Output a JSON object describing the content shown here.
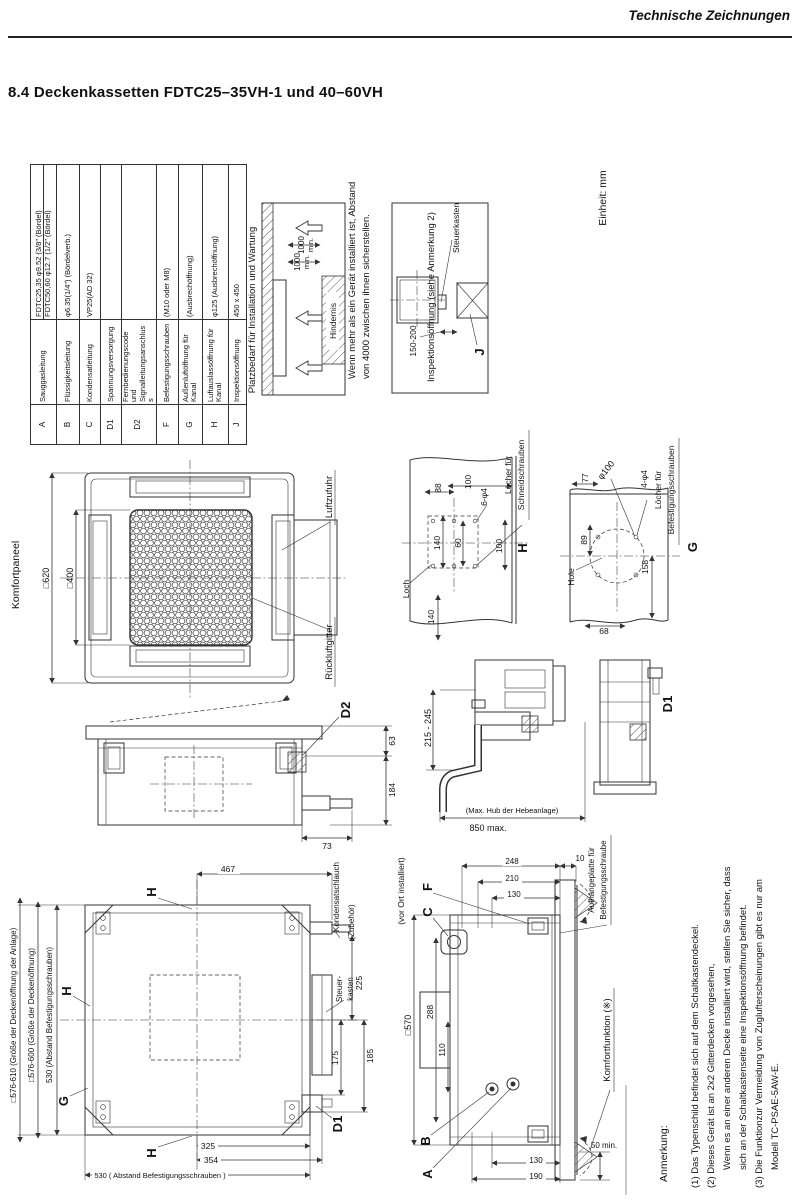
{
  "page": {
    "doc_header": "Technische Zeichnungen",
    "section_title": "8.4  Deckenkassetten FDTC25–35VH-1 und 40–60VH",
    "unit_note": "Einheit: mm"
  },
  "spec_table": {
    "rows": [
      {
        "symbol": "A",
        "name": "Sauggasleitung",
        "value": "FDTC25,35  φ9.52 (3/8\" (Bördel)",
        "value2": "FDTC50,60  φ12.7 (1/2\" (Bördel)"
      },
      {
        "symbol": "B",
        "name": "Flüssigkeitsleitung",
        "value": "φ6.35(1/4\") (Bördelverb.)"
      },
      {
        "symbol": "C",
        "name": "Kondensatleitung",
        "value": "VP25(AD 32)"
      },
      {
        "symbol": "D1",
        "name": "Spannungsversorgung",
        "value": ""
      },
      {
        "symbol": "D2",
        "name": "Fernbedienungscode und Signalleitungsanschluss",
        "value": ""
      },
      {
        "symbol": "F",
        "name": "Befestigungsschrauben",
        "value": "(M10 oder M8)"
      },
      {
        "symbol": "G",
        "name": "Außenluftöffnung für Kanal",
        "value": "(Ausbrechöffnung)"
      },
      {
        "symbol": "H",
        "name": "Luftauslassöffnung für Kanal",
        "value": "φ125 (Ausbrechöffnung)"
      },
      {
        "symbol": "J",
        "name": "Inspektionsöffnung",
        "value": "450 x 450"
      }
    ]
  },
  "install": {
    "title": "Platzbedarf für Installation und Wartung",
    "clearance1": "1000",
    "clearance1_min": "min.",
    "clearance2": "1000",
    "clearance2_min": "min.",
    "obstacle": "Hindernis",
    "note_line1": "Wenn mehr als ein Gerät installiert ist, Abstand",
    "note_line2": "von 4000 zwischen ihnen sicherstellen.",
    "inspection_note": "Inspektionsöffnung (siehe Anmerkung 2)",
    "control_box": "Steuerkasten",
    "gap_dim": "150-200",
    "j": "J"
  },
  "panel": {
    "name": "Komfortpaneel",
    "outer": "□620",
    "inner": "□400",
    "supply": "Luftzufuhr",
    "return": "Rückluftgitter"
  },
  "hole_h": {
    "qty": "6-φ4",
    "label1": "Löcher für",
    "label2": "Schneidschrauben",
    "d1": "100",
    "d2": "88",
    "d3": "140",
    "d4": "60",
    "d5": "100",
    "d6": "140",
    "loch": "Loch",
    "letter": "H"
  },
  "hole_g": {
    "d77": "77",
    "phi": "φ100",
    "qty": "4-φ4",
    "label1": "Löcher für",
    "label2": "Befestigungsschrauben",
    "d89": "89",
    "d158": "158",
    "hole": "Hole",
    "d68": "68",
    "letter": "G"
  },
  "side": {
    "letter": "D2",
    "d63": "63",
    "d184": "184",
    "d73": "73"
  },
  "lift": {
    "d_range": "215 - 245",
    "d_max": "850 max.",
    "hub": "(Max. Hub der Hebeanlage)",
    "letter": "D1"
  },
  "unit_top": {
    "h_top": "H",
    "h_left": "H",
    "g_left": "G",
    "h_bottom": "H",
    "d1": "D1",
    "bolt_pitch_left": "530  (Abstand Befestigungsschrauben)",
    "opening": "□576-600 (Größe der Deckenöffnung)",
    "opening_unit": "□576-610 (Größe der Deckenöffnung der Anlage)",
    "d467": "467",
    "drain1": "Kondensatschlauch",
    "drain2": "(Zubehör)",
    "ctrl1": "Steuer-",
    "ctrl2": "kasten",
    "d225": "225",
    "d175": "175",
    "d185": "185",
    "d325": "325",
    "d354": "354",
    "bolt_pitch_bottom": "530 ( Abstand Befestigungsschrauben )"
  },
  "section": {
    "field_note": "(vor Ort installiert)",
    "a": "A",
    "b": "B",
    "c": "C",
    "f": "F",
    "d570": "□570",
    "d288": "288",
    "d110": "110",
    "d248": "248",
    "d210": "210",
    "d130t": "130",
    "d10": "10",
    "hang1": "Aufhängeplatte für",
    "hang2": "Befestigungsschraube",
    "comfort": "Komfortfunktion (※)",
    "d50": "50 min.",
    "d130b": "130",
    "d190": "190"
  },
  "notes": {
    "heading": "Anmerkung:",
    "line1": "(1) Das Typenschild befindet sich auf dem Schaltkastendeckel.",
    "line2": "(2) Dieses Gerät ist an 2x2 Gitterdecken vorgesehen,",
    "line3": "Wenn es an einer anderen Decke installiert wird, stellen Sie sicher, dass",
    "line4": "sich an der Schaltkastenseite eine Inspektionsöffnung befindet.",
    "line5": "(3) Die Funktionzur Vermeidung von Zuglufterscheinungen gibt es nur am",
    "line6": "Modell TC-PSAE-5AW-E."
  }
}
